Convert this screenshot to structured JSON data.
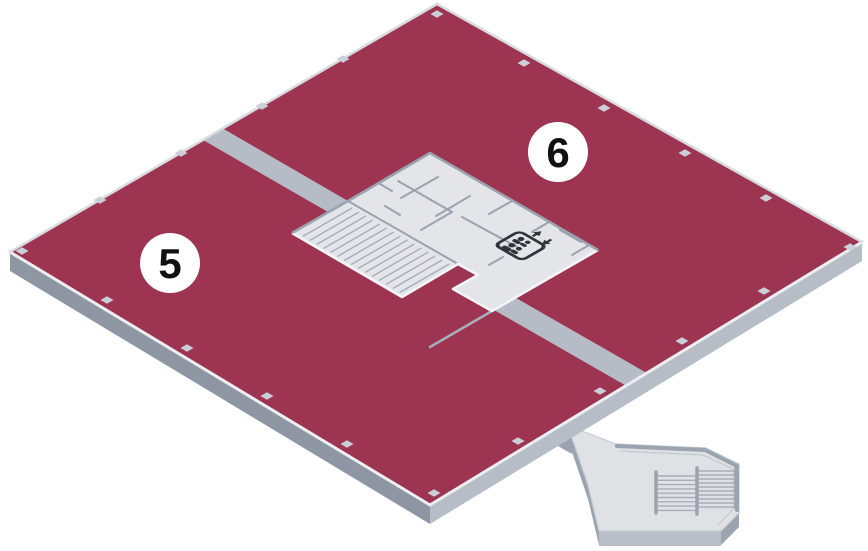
{
  "map": {
    "name": "isometric-building-floor-map",
    "markers": [
      {
        "label": "5"
      },
      {
        "label": "6"
      }
    ],
    "core": {
      "elevator_icon": "elevator-people-up-down-arrows",
      "features": [
        "staircase",
        "elevator-lobby",
        "rooms"
      ]
    },
    "exterior": {
      "features": [
        "bridge-corridor",
        "external-staircase"
      ]
    }
  },
  "colors": {
    "bg": "#ffffff",
    "floor-top": "#9c3452",
    "floor-side-dark": "#8d96a2",
    "floor-side-light": "#b7bdc7",
    "edge-rim": "#eceef1",
    "edge-line": "#d8dce1",
    "corridor": "#b5bcc6",
    "core-floor": "#e3e5e9",
    "core-wall": "#9ba3af",
    "core-rim": "#f4f5f7",
    "stair-line": "#a8aeb9",
    "marker-diamond": "#cbd0d8",
    "circle-fill": "#ffffff",
    "circle-text": "#111111",
    "icon-dark": "#32333b",
    "struct-floor": "#dfe1e5",
    "struct-side": "#9aa3ae",
    "struct-bottom": "#b8bec8"
  }
}
